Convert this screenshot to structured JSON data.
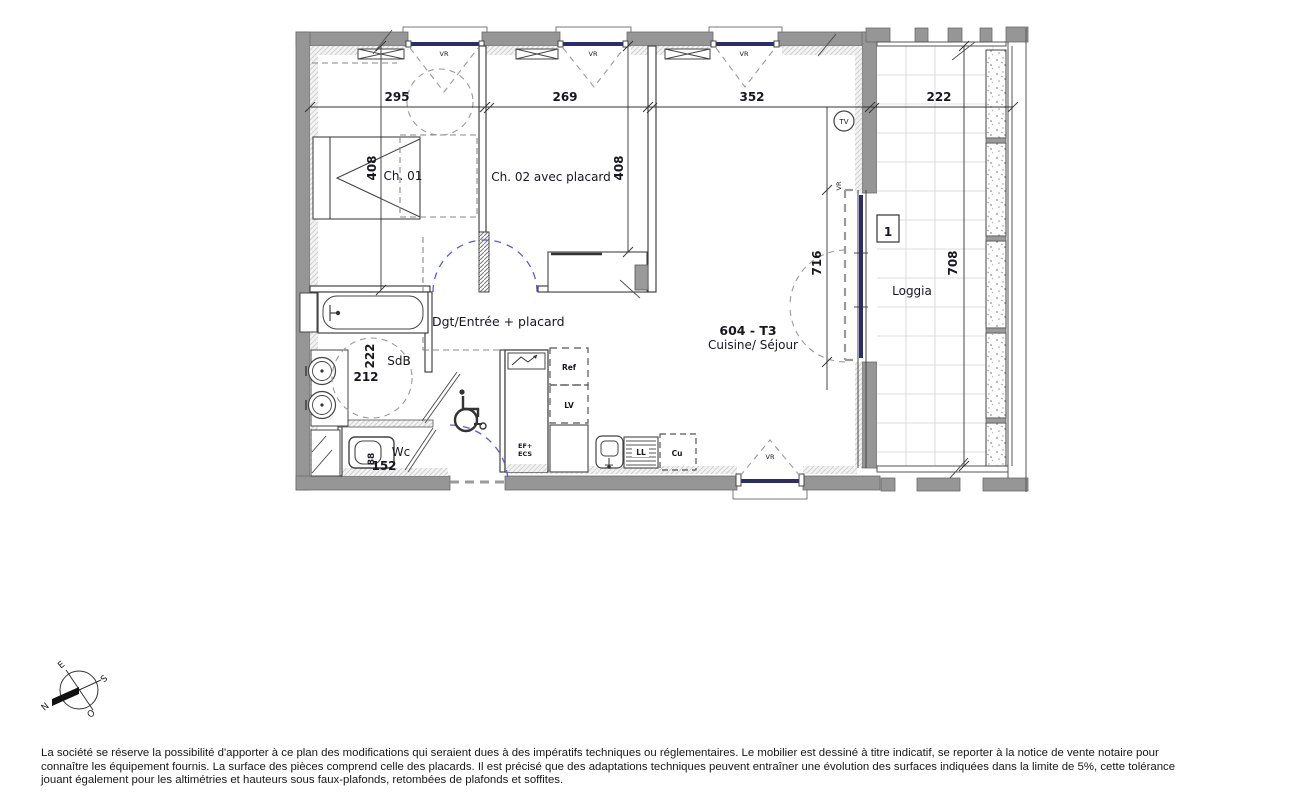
{
  "plan": {
    "rooms": {
      "ch01": "Ch. 01",
      "ch02": "Ch. 02 avec placard",
      "entry": "Dgt/Entrée + placard",
      "sdb": "SdB",
      "wc": "Wc",
      "unit_title": "604 - T3",
      "unit_subtitle": "Cuisine/ Séjour",
      "loggia": "Loggia"
    },
    "dimensions": {
      "top_295": "295",
      "top_269": "269",
      "top_352": "352",
      "top_222": "222",
      "depth_408_ch01": "408",
      "depth_408_ch02": "408",
      "bay_716": "716",
      "loggia_708": "708",
      "sdb_222": "222",
      "sdb_212": "212",
      "wc_152": "152",
      "wc_88": "88"
    },
    "labels": {
      "vr": "VR",
      "tv": "TV",
      "door_number": "1",
      "ref": "Ref",
      "lv": "LV",
      "ll": "LL",
      "cu": "Cu",
      "ef": "EF+",
      "ecs": "ECS"
    },
    "compass": {
      "n": "N",
      "e": "E",
      "s": "S",
      "o": "O"
    }
  },
  "disclaimer": {
    "lines": [
      "La société se réserve la possibilité d'apporter à ce plan des modifications qui seraient dues à des impératifs techniques ou réglementaires. Le mobilier est dessiné à titre indicatif, se reporter à la notice de vente notaire pour",
      "connaître les équipement fournis. La surface des pièces comprend celle des placards. Il est précisé que des adaptations techniques peuvent entraîner une évolution des surfaces indiquées dans la limite de 5%, cette tolérance",
      "jouant également pour les altimétries et hauteurs sous faux-plafonds, retombées de plafonds et soffites."
    ]
  },
  "colors": {
    "wall": "#969696",
    "line": "#3f3f46",
    "window_glazing": "#2b2b6e",
    "dashed_blue": "#5b5bd6",
    "text": "#17171f"
  }
}
